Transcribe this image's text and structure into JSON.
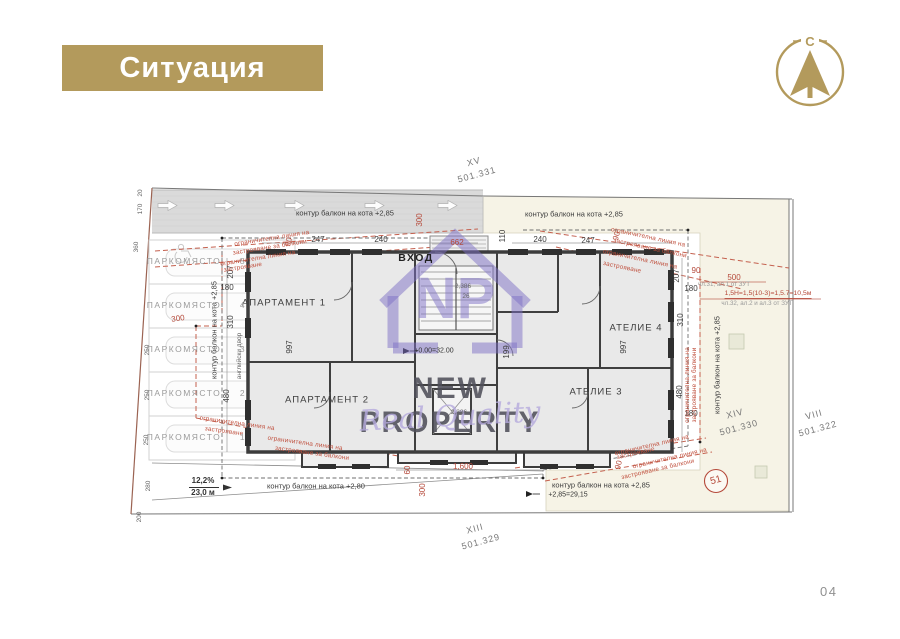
{
  "header": {
    "title": "Ситуация"
  },
  "compass": {
    "letter": "С"
  },
  "watermark": {
    "monogram": "NP",
    "name": "NEW PROPERTY",
    "tagline": "Real Quality"
  },
  "page_number": "04",
  "colors": {
    "accent": "#b39a5c",
    "annotation_red": "#b5493a",
    "wall": "#3c3c3c",
    "neighbor_parcel": "#f6f3e6",
    "watermark_purple": "#7e6fc5"
  },
  "plan": {
    "labels": [
      {
        "t": "247",
        "x": 318,
        "y": 240,
        "c": "dim",
        "n": "dim-247-top-left"
      },
      {
        "t": "240",
        "x": 381,
        "y": 240,
        "c": "dim",
        "n": "dim-240-top-left"
      },
      {
        "t": "110",
        "x": 503,
        "y": 236,
        "r": -90,
        "c": "dim",
        "n": "dim-110-top"
      },
      {
        "t": "240",
        "x": 540,
        "y": 240,
        "c": "dim",
        "n": "dim-240-top-right"
      },
      {
        "t": "247",
        "x": 588,
        "y": 241,
        "c": "dim",
        "n": "dim-247-top-right"
      },
      {
        "t": "207",
        "x": 231,
        "y": 272,
        "r": -90,
        "c": "dim",
        "n": "dim-207-left"
      },
      {
        "t": "180",
        "x": 227,
        "y": 288,
        "c": "dim",
        "n": "dim-180-left"
      },
      {
        "t": "310",
        "x": 231,
        "y": 322,
        "r": -90,
        "c": "dim",
        "n": "dim-310-left"
      },
      {
        "t": "480",
        "x": 227,
        "y": 396,
        "r": -90,
        "c": "dim",
        "n": "dim-480-left"
      },
      {
        "t": "997",
        "x": 290,
        "y": 347,
        "r": -90,
        "c": "dim",
        "n": "dim-997-left"
      },
      {
        "t": "199",
        "x": 507,
        "y": 352,
        "r": -90,
        "c": "dim",
        "n": "dim-199-center"
      },
      {
        "t": "997",
        "x": 624,
        "y": 347,
        "r": -90,
        "c": "dim",
        "n": "dim-997-right"
      },
      {
        "t": "207",
        "x": 677,
        "y": 276,
        "r": -90,
        "c": "dim",
        "n": "dim-207-right"
      },
      {
        "t": "180",
        "x": 691,
        "y": 289,
        "c": "dim",
        "n": "dim-180-right-top"
      },
      {
        "t": "310",
        "x": 681,
        "y": 320,
        "r": -90,
        "c": "dim",
        "n": "dim-310-right"
      },
      {
        "t": "480",
        "x": 680,
        "y": 392,
        "r": -90,
        "c": "dim",
        "n": "dim-480-right"
      },
      {
        "t": "180",
        "x": 691,
        "y": 414,
        "c": "dim",
        "n": "dim-180-right-bottom"
      },
      {
        "t": "20",
        "x": 141,
        "y": 193,
        "r": -90,
        "c": "tiny",
        "n": "dim-20-boundary"
      },
      {
        "t": "170",
        "x": 141,
        "y": 209,
        "r": -90,
        "c": "tiny",
        "n": "dim-170-boundary"
      },
      {
        "t": "360",
        "x": 137,
        "y": 247,
        "r": -90,
        "c": "tiny",
        "n": "dim-360-boundary"
      },
      {
        "t": "250",
        "x": 148,
        "y": 350,
        "r": -90,
        "c": "tiny",
        "n": "dim-250-boundary-1"
      },
      {
        "t": "250",
        "x": 148,
        "y": 395,
        "r": -90,
        "c": "tiny",
        "n": "dim-250-boundary-2"
      },
      {
        "t": "250",
        "x": 147,
        "y": 440,
        "r": -90,
        "c": "tiny",
        "n": "dim-250-boundary-3"
      },
      {
        "t": "280",
        "x": 149,
        "y": 486,
        "r": -90,
        "c": "tiny",
        "n": "dim-280-boundary"
      },
      {
        "t": "200",
        "x": 140,
        "y": 517,
        "r": -90,
        "c": "tiny",
        "n": "dim-200-boundary"
      },
      {
        "t": "2,386",
        "x": 463,
        "y": 287,
        "c": "tiny",
        "n": "dim-stair"
      },
      {
        "t": "26",
        "x": 466,
        "y": 297,
        "c": "tiny",
        "n": "stair-count"
      },
      {
        "t": "2,386",
        "x": 459,
        "y": 413,
        "c": "tiny",
        "n": "dim-elevator"
      },
      {
        "t": "300",
        "x": 420,
        "y": 220,
        "r": -90,
        "c": "red",
        "n": "red-dim-300-top"
      },
      {
        "t": "662",
        "x": 457,
        "y": 243,
        "c": "red",
        "n": "red-dim-662"
      },
      {
        "t": "90",
        "x": 289,
        "y": 242,
        "r": -75,
        "c": "red",
        "n": "red-dim-90-topleft"
      },
      {
        "t": "90",
        "x": 617,
        "y": 236,
        "r": -75,
        "c": "red",
        "n": "red-dim-90-topright"
      },
      {
        "t": "300",
        "x": 178,
        "y": 319,
        "r": -8,
        "c": "red",
        "n": "red-dim-300-left"
      },
      {
        "t": "500",
        "x": 734,
        "y": 278,
        "c": "red",
        "n": "red-dim-500"
      },
      {
        "t": "90",
        "x": 696,
        "y": 271,
        "c": "red",
        "n": "red-dim-90-right"
      },
      {
        "t": "1,600",
        "x": 463,
        "y": 467,
        "c": "red",
        "n": "red-dim-1600"
      },
      {
        "t": "60",
        "x": 408,
        "y": 470,
        "r": -90,
        "c": "red",
        "n": "red-dim-60"
      },
      {
        "t": "300",
        "x": 423,
        "y": 490,
        "r": -90,
        "c": "red",
        "n": "red-dim-300-bottom"
      },
      {
        "t": "90",
        "x": 619,
        "y": 465,
        "r": -75,
        "c": "red",
        "n": "red-dim-90-bottomright"
      },
      {
        "t": "ограничителна линия на",
        "x": 272,
        "y": 239,
        "r": -9,
        "c": "rednote",
        "n": "regulation-note"
      },
      {
        "t": "застрояване за балкони",
        "x": 270,
        "y": 248,
        "r": -9,
        "c": "rednote",
        "n": "regulation-note"
      },
      {
        "t": "ограничителна линия на",
        "x": 258,
        "y": 259,
        "r": -9,
        "c": "rednote",
        "n": "regulation-note"
      },
      {
        "t": "застрояване",
        "x": 243,
        "y": 268,
        "r": -9,
        "c": "rednote",
        "n": "regulation-note"
      },
      {
        "t": "ограничителна линия на",
        "x": 648,
        "y": 238,
        "r": 12,
        "c": "rednote",
        "n": "regulation-note"
      },
      {
        "t": "застрояване за балкони",
        "x": 650,
        "y": 249,
        "r": 12,
        "c": "rednote",
        "n": "regulation-note"
      },
      {
        "t": "ограничителна линия на",
        "x": 640,
        "y": 260,
        "r": 12,
        "c": "rednote",
        "n": "regulation-note"
      },
      {
        "t": "застрояване",
        "x": 622,
        "y": 268,
        "r": 12,
        "c": "rednote",
        "n": "regulation-note"
      },
      {
        "t": "ограничителна линия на",
        "x": 237,
        "y": 424,
        "r": 8,
        "c": "rednote",
        "n": "regulation-note"
      },
      {
        "t": "застрояване",
        "x": 224,
        "y": 432,
        "r": 8,
        "c": "rednote",
        "n": "regulation-note"
      },
      {
        "t": "ограничителна линия на",
        "x": 305,
        "y": 444,
        "r": 8,
        "c": "rednote",
        "n": "regulation-note"
      },
      {
        "t": "застрояване за балкони",
        "x": 312,
        "y": 454,
        "r": 8,
        "c": "rednote",
        "n": "regulation-note"
      },
      {
        "t": "ограничителна линия на",
        "x": 652,
        "y": 446,
        "r": -13,
        "c": "rednote",
        "n": "regulation-note"
      },
      {
        "t": "застрояване",
        "x": 636,
        "y": 454,
        "r": -13,
        "c": "rednote",
        "n": "regulation-note"
      },
      {
        "t": "ограничителна линия на",
        "x": 670,
        "y": 459,
        "r": -13,
        "c": "rednote",
        "n": "regulation-note"
      },
      {
        "t": "застрояване за балкони",
        "x": 658,
        "y": 470,
        "r": -13,
        "c": "rednote",
        "n": "regulation-note"
      },
      {
        "t": "ограничителна линия на",
        "x": 688,
        "y": 385,
        "r": -90,
        "c": "rednote",
        "n": "regulation-note"
      },
      {
        "t": "застрояване за балкони",
        "x": 695,
        "y": 385,
        "r": -90,
        "c": "rednote",
        "n": "regulation-note"
      },
      {
        "t": "контур балкон на кота +2,85",
        "x": 345,
        "y": 213,
        "c": "ctr",
        "n": "balcony-contour-label"
      },
      {
        "t": "контур балкон на кота +2,85",
        "x": 574,
        "y": 214,
        "c": "ctr",
        "n": "balcony-contour-label"
      },
      {
        "t": "контур балкон на кота +2,85",
        "x": 214,
        "y": 330,
        "r": -90,
        "c": "ctr",
        "n": "balcony-contour-label"
      },
      {
        "t": "контур балкон на кота +2,85",
        "x": 717,
        "y": 365,
        "r": -90,
        "c": "ctr",
        "n": "balcony-contour-label"
      },
      {
        "t": "контур балкон на кота +2,80",
        "x": 316,
        "y": 486,
        "c": "ctr",
        "n": "balcony-contour-label"
      },
      {
        "t": "контур балкон на кота +2,85",
        "x": 601,
        "y": 485,
        "c": "ctr",
        "n": "balcony-contour-label"
      },
      {
        "t": "английски двор",
        "x": 240,
        "y": 356,
        "r": -90,
        "c": "tiny",
        "n": "english-yard-label"
      },
      {
        "t": "АПАРТАМЕНТ 1",
        "x": 284,
        "y": 303,
        "c": "room",
        "n": "room-label-apartment-1"
      },
      {
        "t": "АПАРТАМЕНТ 2",
        "x": 327,
        "y": 400,
        "c": "room",
        "n": "room-label-apartment-2"
      },
      {
        "t": "АТЕЛИЕ 4",
        "x": 636,
        "y": 328,
        "c": "room",
        "n": "room-label-atelier-4"
      },
      {
        "t": "АТЕЛИЕ 3",
        "x": 596,
        "y": 392,
        "c": "room",
        "n": "room-label-atelier-3"
      },
      {
        "t": "ВХОД",
        "x": 416,
        "y": 258,
        "c": "entry",
        "n": "entrance-label"
      },
      {
        "t": "ПАРКОМЯСТО",
        "x": 184,
        "y": 261,
        "c": "park",
        "n": "parking-spot-label"
      },
      {
        "t": "5",
        "x": 243,
        "y": 261,
        "c": "park",
        "n": "parking-spot-number"
      },
      {
        "t": "ПАРКОМЯСТО",
        "x": 184,
        "y": 305,
        "c": "park",
        "n": "parking-spot-label"
      },
      {
        "t": "4",
        "x": 243,
        "y": 305,
        "c": "park",
        "n": "parking-spot-number"
      },
      {
        "t": "ПАРКОМЯСТО",
        "x": 184,
        "y": 349,
        "c": "park",
        "n": "parking-spot-label"
      },
      {
        "t": "3",
        "x": 243,
        "y": 349,
        "c": "park",
        "n": "parking-spot-number"
      },
      {
        "t": "ПАРКОМЯСТО",
        "x": 184,
        "y": 393,
        "c": "park",
        "n": "parking-spot-label"
      },
      {
        "t": "2",
        "x": 243,
        "y": 393,
        "c": "park",
        "n": "parking-spot-number"
      },
      {
        "t": "ПАРКОМЯСТО",
        "x": 184,
        "y": 437,
        "c": "park",
        "n": "parking-spot-label"
      },
      {
        "t": "1",
        "x": 243,
        "y": 437,
        "c": "park",
        "n": "parking-spot-number"
      },
      {
        "t": "XV",
        "x": 474,
        "y": 162,
        "r": -15,
        "c": "plot",
        "n": "plot-id-xv"
      },
      {
        "t": "501.331",
        "x": 477,
        "y": 175,
        "r": -15,
        "c": "plot",
        "n": "plot-elevation-xv"
      },
      {
        "t": "XIII",
        "x": 475,
        "y": 529,
        "r": -15,
        "c": "plot",
        "n": "plot-id-xiii"
      },
      {
        "t": "501.329",
        "x": 481,
        "y": 542,
        "r": -15,
        "c": "plot",
        "n": "plot-elevation-xiii"
      },
      {
        "t": "XIV",
        "x": 735,
        "y": 414,
        "r": -15,
        "c": "plot",
        "n": "plot-id-xiv"
      },
      {
        "t": "501.330",
        "x": 739,
        "y": 428,
        "r": -15,
        "c": "plot",
        "n": "plot-elevation-xiv"
      },
      {
        "t": "VIII",
        "x": 814,
        "y": 415,
        "r": -15,
        "c": "plot",
        "n": "plot-id-viii"
      },
      {
        "t": "501.322",
        "x": 818,
        "y": 429,
        "r": -15,
        "c": "plot",
        "n": "plot-elevation-viii"
      },
      {
        "t": "чл.31, ал.1 от ЗУТ",
        "x": 724,
        "y": 285,
        "c": "law",
        "n": "law-reference"
      },
      {
        "t": "1,5Н=1,5(10-3)=1,5.7=10,5м",
        "x": 768,
        "y": 295,
        "c": "lawred",
        "n": "height-formula"
      },
      {
        "t": "чл.32, ал.2 и ал.3 от ЗУТ",
        "x": 757,
        "y": 304,
        "c": "law",
        "n": "law-reference"
      },
      {
        "t": "+0.00=32.00",
        "x": 434,
        "y": 351,
        "c": "tiny2",
        "n": "elevation-marker-label"
      },
      {
        "t": "+2,85=29,15",
        "x": 568,
        "y": 495,
        "c": "tiny2",
        "n": "elevation-marker-label"
      },
      {
        "t": "12,2%",
        "x": 203,
        "y": 481,
        "c": "slope",
        "n": "ramp-slope-percent"
      },
      {
        "t": "23,0 м",
        "x": 203,
        "y": 493,
        "c": "slope",
        "n": "ramp-length"
      },
      {
        "t": "51",
        "x": 716,
        "y": 481,
        "r": -15,
        "c": "circ51",
        "n": "point-51-label"
      }
    ]
  }
}
